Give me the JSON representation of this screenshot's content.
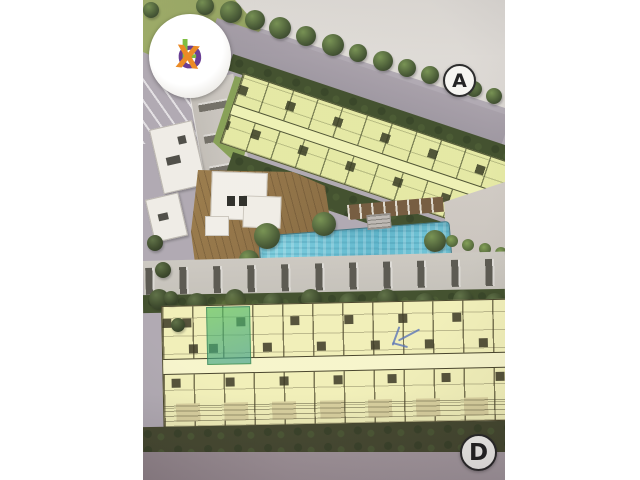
{
  "photo": {
    "description": "Photographed aerial site development plan of a residential complex: two long residential floor-plan buildings (A and D), central wooden amenity deck, clubhouse and swimming pool, surrounded by trees, roads and parking",
    "watermark": {
      "name": "OLX",
      "letters": [
        {
          "char": "O",
          "color": "#6a3d97"
        },
        {
          "char": "L",
          "color": "#7cbf3e"
        },
        {
          "char": "X",
          "color": "#ee8a21"
        }
      ]
    },
    "badges": [
      {
        "label": "A"
      },
      {
        "label": "D"
      }
    ],
    "annotations": {
      "highlighted_unit_color": "#46b84e",
      "pen_note_color": "#4f6cb5"
    },
    "colors": {
      "floorplan_fill": "#efedb2",
      "floorplan_lines": "#433f1f",
      "pool_water": "#62c2da",
      "wood_deck": "#8d6c3e",
      "hedge_dark_green": "#36451f",
      "lawn_green": "#95a557",
      "pavement_gray": "#aba4ad",
      "bottom_pavement": "#9b8e94",
      "paper_white": "#ffffff"
    }
  }
}
